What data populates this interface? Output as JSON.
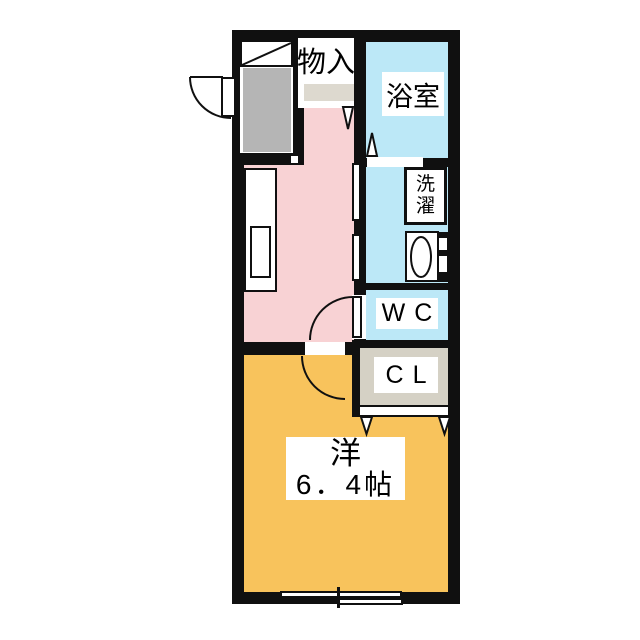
{
  "rooms": {
    "storage": {
      "label": "物入"
    },
    "bathroom": {
      "label": "浴室"
    },
    "laundry": {
      "label": "洗濯",
      "char1": "洗",
      "char2": "濯"
    },
    "wc": {
      "label": "WC"
    },
    "closet": {
      "label": "CL"
    },
    "western_room": {
      "label": "洋",
      "size": "6．4帖"
    }
  },
  "colors": {
    "wall": "#101010",
    "kitchen_floor": "#f8d2d4",
    "wet_area_floor": "#bce8f7",
    "western_room_floor": "#f8c35c",
    "entry_floor": "#b5b5b5",
    "closet_floor": "#d5d1c5",
    "storage_shelf": "#ddd9cf",
    "fixture": "#ffffff"
  }
}
